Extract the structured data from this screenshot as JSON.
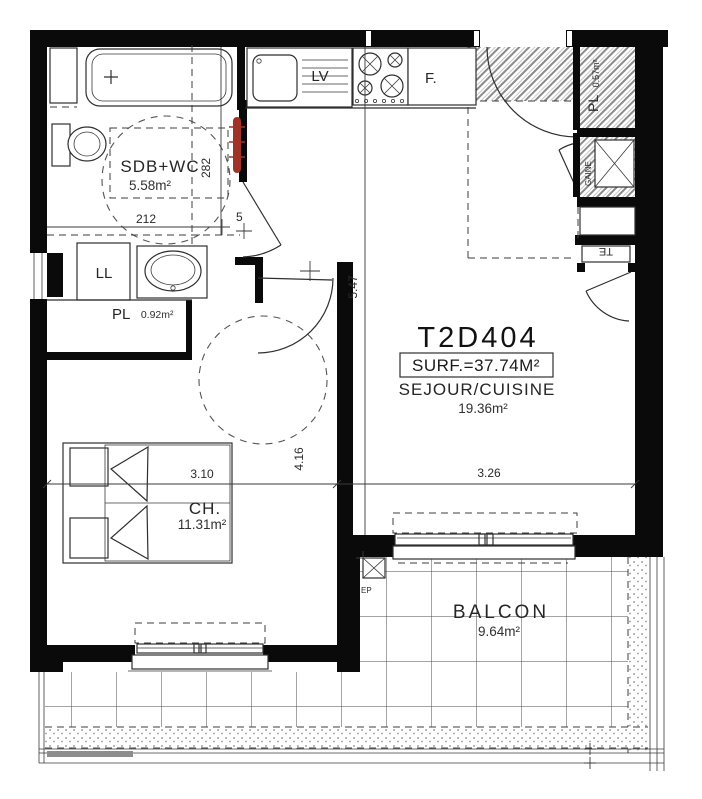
{
  "unit": {
    "id": "T2D404",
    "surface": "SURF.=37.74M²"
  },
  "rooms": {
    "sejour": {
      "name": "SEJOUR/CUISINE",
      "area": "19.36m²"
    },
    "sdb": {
      "name": "SDB+WC",
      "area": "5.58m²"
    },
    "chambre": {
      "name": "CH.",
      "area": "11.31m²"
    },
    "balcon": {
      "name": "BALCON",
      "area": "9.64m²"
    },
    "placard_hall": {
      "name": "PL",
      "area": "0.92m²"
    },
    "placard_entree": {
      "name": "PL",
      "area": "0.57m²"
    },
    "gaine": {
      "name": "GAINE"
    }
  },
  "appliances": {
    "lave_vaisselle": "LV",
    "frigo": "F.",
    "lave_linge": "LL",
    "tableau_electrique": "TE",
    "eaux_pluviales": "EP"
  },
  "dimensions": {
    "sdb_largeur": "212",
    "sdb_hauteur": "282",
    "porte_sdb": "5",
    "hall_hauteur": "5.47",
    "chambre_largeur": "3.10",
    "chambre_hauteur": "4.16",
    "sejour_largeur": "3.26"
  },
  "colors": {
    "wall": "#0a0a0a",
    "radiator": "#a03329",
    "hatch": "#8a8a8a"
  }
}
